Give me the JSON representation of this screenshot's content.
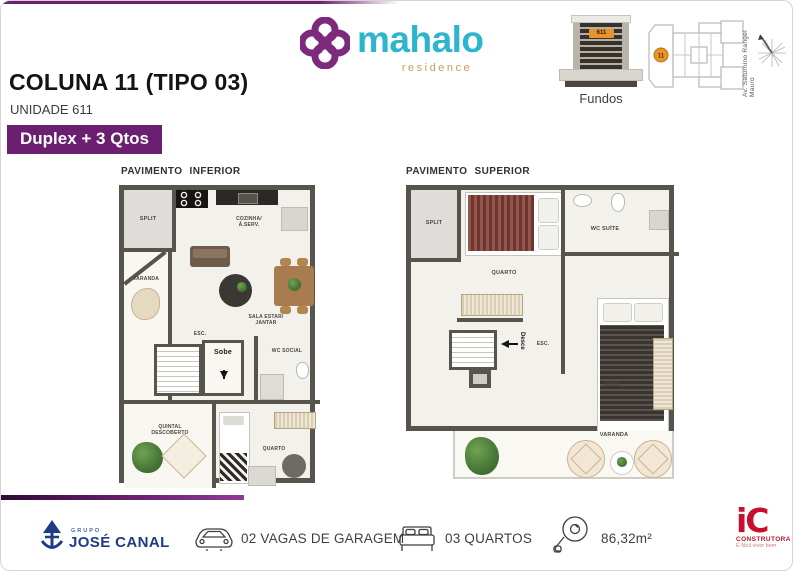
{
  "brand": {
    "wordmark": "mahalo",
    "subtitle": "residence"
  },
  "header": {
    "title": "COLUNA 11 (TIPO 03)",
    "unit": "UNIDADE 611",
    "badge": "Duplex + 3 Qtos"
  },
  "locator": {
    "building_caption": "Fundos",
    "building_unit_badge": "611",
    "siteplan_unit": "11",
    "street_label": "Av. Saturnino Rangel Mauro"
  },
  "plan_inferior": {
    "title": "PAVIMENTO INFERIOR",
    "split": "SPLIT",
    "cozinha": "COZINHA/\nÁ.SERV.",
    "varanda": "VARANDA",
    "sala": "SALA ESTAR/\nJANTAR",
    "esc": "ESC.",
    "sobe": "Sobe",
    "wc_social": "WC SOCIAL",
    "quintal": "QUINTAL\nDESCOBERTO",
    "quarto": "QUARTO"
  },
  "plan_superior": {
    "title": "PAVIMENTO SUPERIOR",
    "split": "SPLIT",
    "quarto": "QUARTO",
    "wc_suite": "WC SUÍTE",
    "suite": "SUÍTE",
    "esc": "ESC.",
    "desce": "Desce",
    "varanda": "VARANDA"
  },
  "footer": {
    "group": "GRUPO",
    "company": "JOSÉ CANAL",
    "garage": "02 VAGAS DE GARAGEM",
    "bedrooms": "03 QUARTOS",
    "area": "86,32m²",
    "builder_mark": "iC",
    "builder_name": "CONSTRUTORA",
    "builder_tagline": "É fácil viver bem."
  },
  "colors": {
    "purple": "#6B1F70",
    "teal": "#2CB5CC",
    "tan": "#C3A05C",
    "navy": "#1E3C85",
    "red": "#C8102E",
    "wall": "#57544B",
    "orange": "#E8932C"
  }
}
